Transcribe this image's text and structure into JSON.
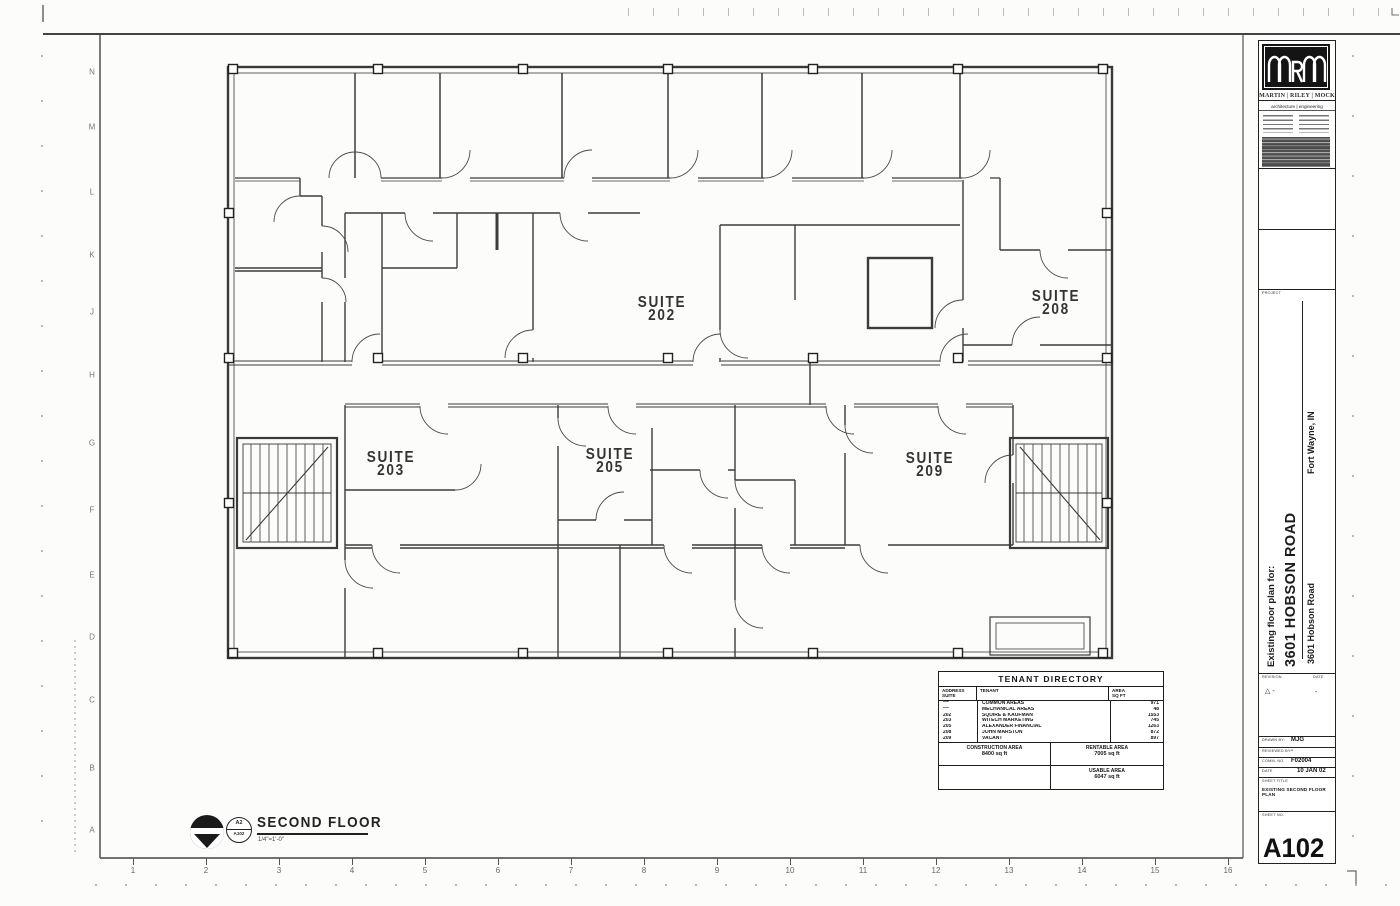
{
  "sheet": {
    "grid_letters": [
      {
        "label": "N",
        "y": 72
      },
      {
        "label": "M",
        "y": 127
      },
      {
        "label": "L",
        "y": 192
      },
      {
        "label": "K",
        "y": 255
      },
      {
        "label": "J",
        "y": 312
      },
      {
        "label": "H",
        "y": 375
      },
      {
        "label": "G",
        "y": 443
      },
      {
        "label": "F",
        "y": 510
      },
      {
        "label": "E",
        "y": 575
      },
      {
        "label": "D",
        "y": 637
      },
      {
        "label": "C",
        "y": 700
      },
      {
        "label": "B",
        "y": 768
      },
      {
        "label": "A",
        "y": 830
      }
    ],
    "grid_numbers": [
      "1",
      "2",
      "3",
      "4",
      "5",
      "6",
      "7",
      "8",
      "9",
      "10",
      "11",
      "12",
      "13",
      "14",
      "15",
      "16"
    ]
  },
  "plan": {
    "suites": [
      {
        "word": "SUITE",
        "number": "202",
        "x": 662,
        "y": 297
      },
      {
        "word": "SUITE",
        "number": "208",
        "x": 1056,
        "y": 291
      },
      {
        "word": "SUITE",
        "number": "203",
        "x": 391,
        "y": 452
      },
      {
        "word": "SUITE",
        "number": "205",
        "x": 610,
        "y": 449
      },
      {
        "word": "SUITE",
        "number": "209",
        "x": 930,
        "y": 453
      }
    ]
  },
  "tenant_directory": {
    "title": "TENANT DIRECTORY",
    "columns": {
      "address_line1": "ADDRESS",
      "address_line2": "SUITE",
      "tenant": "TENANT",
      "area_line1": "AREA",
      "area_line2": "SQ FT"
    },
    "rows": [
      {
        "suite": "***",
        "tenant": "COMMON AREAS",
        "area": "971"
      },
      {
        "suite": "***",
        "tenant": "MECHANICAL AREAS",
        "area": "48"
      },
      {
        "suite": "202",
        "tenant": "SQUIRE & KAUFMAN",
        "area": "1553"
      },
      {
        "suite": "203",
        "tenant": "WITECH MARKETING",
        "area": "745"
      },
      {
        "suite": "205",
        "tenant": "ALEXANDER FINANCIAL",
        "area": "1263"
      },
      {
        "suite": "208",
        "tenant": "JOHN MARSTON",
        "area": "872"
      },
      {
        "suite": "209",
        "tenant": "VACANT",
        "area": "897"
      }
    ],
    "totals": {
      "construction_label": "CONSTRUCTION AREA",
      "construction_value": "8400 sq ft",
      "rentable_label": "RENTABLE AREA",
      "rentable_value": "7005 sq ft",
      "usable_label": "USABLE AREA",
      "usable_value": "6047 sq ft"
    }
  },
  "drawing_title": {
    "ref_top": "A2",
    "ref_bottom": "A102",
    "title": "SECOND FLOOR",
    "scale": "1/4\"=1'-0\""
  },
  "title_block": {
    "firm_name": "MARTIN | RILEY | MOCK",
    "firm_tagline": "architecture | engineering",
    "project_label": "PROJECT",
    "project_prefix": "Existing floor plan for:",
    "project_name": "3601 HOBSON ROAD",
    "project_address": "3601 Hobson Road",
    "project_city": "Fort Wayne, IN",
    "revision_label": "REVISION",
    "revision_date_label": "DATE",
    "revision_mark": "△ -",
    "revision_date": "-",
    "drawn_by_label": "DRAWN BY:",
    "drawn_by": "MJG",
    "reviewed_by_label": "REVIEWED BY:",
    "reviewed_by": "-",
    "comm_no_label": "COMM. NO.",
    "comm_no": "F02004",
    "date_label": "DATE",
    "date": "10 JAN 02",
    "sheet_title_label": "SHEET TITLE",
    "sheet_title": "EXISTING SECOND FLOOR PLAN",
    "sheet_no_label": "SHEET NO.",
    "sheet_no": "A102"
  }
}
